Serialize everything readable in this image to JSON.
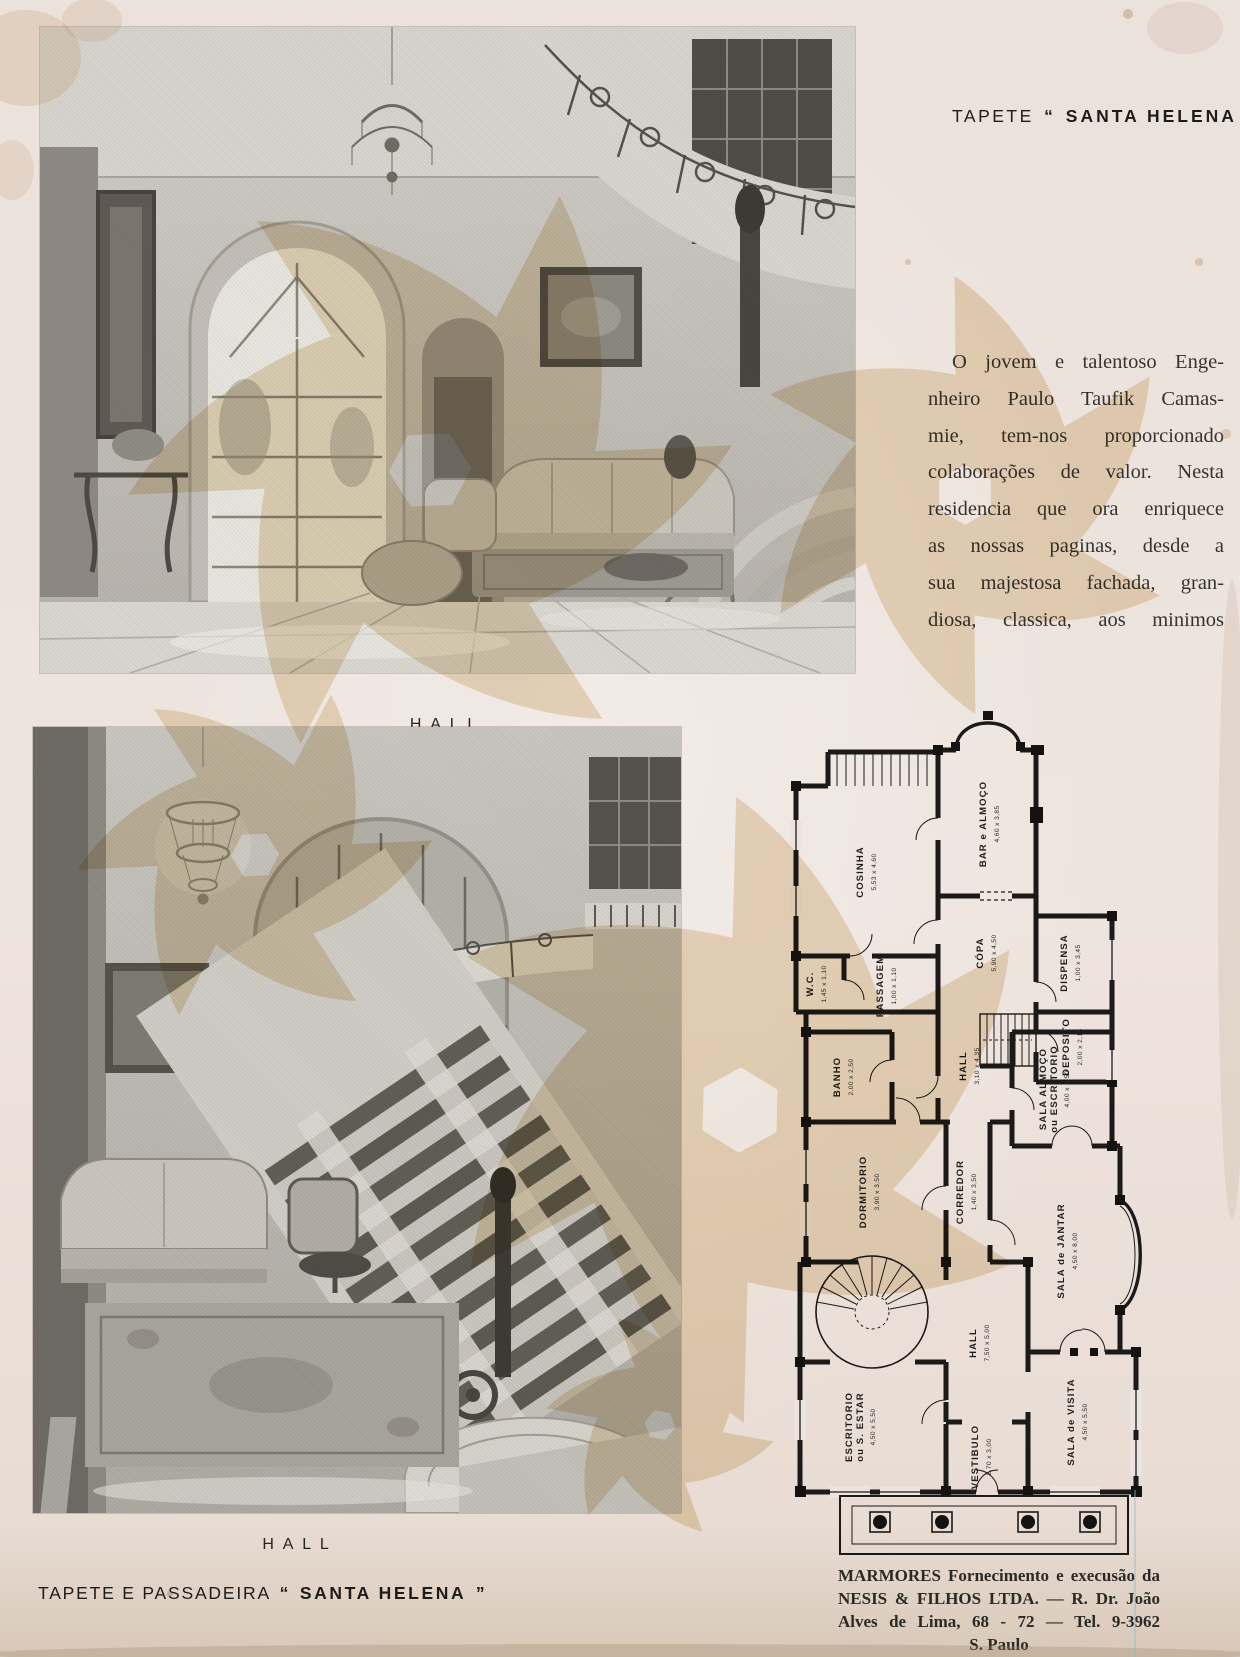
{
  "masthead": {
    "prefix": "TAPETE",
    "open_quote": "“",
    "brand": "SANTA HELENA",
    "close_quote": "”"
  },
  "article": {
    "lines": [
      "O jovem e talentoso Enge-",
      "nheiro Paulo Taufik Camas-",
      "mie, tem-nos proporcionado",
      "colaborações de valor. Nesta",
      "residencia que ora enriquece",
      "as nossas paginas, desde a",
      "sua majestosa fachada, gran-",
      "diosa, classica, aos minimos"
    ]
  },
  "photos": {
    "photo1_caption": "HALL",
    "photo2_caption": "HALL"
  },
  "footer_left": {
    "prefix": "TAPETE E PASSADEIRA",
    "open_quote": "“",
    "brand": "SANTA HELENA",
    "close_quote": "”"
  },
  "credit": {
    "lines": [
      "MARMORES Fornecimento e execusão da",
      "NESIS & FILHOS LTDA. — R. Dr. João",
      "Alves de Lima, 68 - 72 — Tel. 9-3962",
      "S. Paulo"
    ]
  },
  "plan": {
    "rooms": [
      {
        "name": "COSINHA",
        "dims": "5,53 x 4,60",
        "x": 183,
        "y": 172
      },
      {
        "name": "BAR e ALMOÇO",
        "dims": "4,60 x 3,85",
        "x": 306,
        "y": 124
      },
      {
        "name": "CÓPA",
        "dims": "5,90 x 4,50",
        "x": 303,
        "y": 253
      },
      {
        "name": "DISPENSA",
        "dims": "1,00 x 3,45",
        "x": 387,
        "y": 263
      },
      {
        "name": "W.C.",
        "dims": "1,45 x 1,10",
        "x": 133,
        "y": 284
      },
      {
        "name": "PASSAGEM",
        "dims": "1,00 x 1,10",
        "x": 203,
        "y": 286
      },
      {
        "name": "DEPOSITO",
        "dims": "2,00 x 2,15",
        "x": 389,
        "y": 347
      },
      {
        "name": "BANHO",
        "dims": "2,00 x 2,50",
        "x": 160,
        "y": 377
      },
      {
        "name": "HALL",
        "dims": "3,10 x 4,35",
        "x": 286,
        "y": 366
      },
      {
        "name": "SALA ALMOÇO",
        "name2": "ou ESCRITORIO",
        "dims": "4,00 x 3,50",
        "x": 366,
        "y": 389
      },
      {
        "name": "DORMITORIO",
        "dims": "3,90 x 3,50",
        "x": 186,
        "y": 492
      },
      {
        "name": "CORREDOR",
        "dims": "1,40 x 3,50",
        "x": 283,
        "y": 492
      },
      {
        "name": "SALA de JANTAR",
        "dims": "4,50 x 8,00",
        "x": 384,
        "y": 551
      },
      {
        "name": "HALL",
        "dims": "7,50 x 5,00",
        "x": 296,
        "y": 643
      },
      {
        "name": "ESCRITORIO",
        "name2": "ou S. ESTAR",
        "dims": "4,50 x 5,50",
        "x": 172,
        "y": 727
      },
      {
        "name": "VESTIBULO",
        "dims": "2,70 x 3,00",
        "x": 298,
        "y": 757
      },
      {
        "name": "SALA de VISITA",
        "dims": "4,50 x 5,50",
        "x": 394,
        "y": 722
      }
    ]
  }
}
